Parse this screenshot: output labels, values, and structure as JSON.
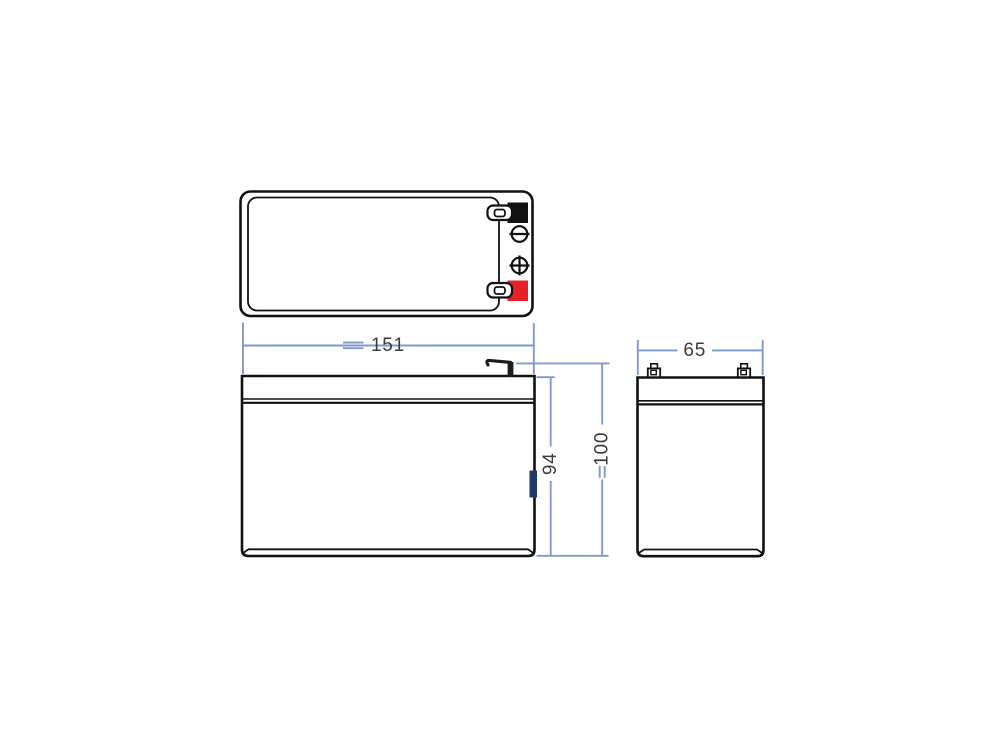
{
  "colors": {
    "outline": "#111111",
    "dimension_line": "#7E99CE",
    "label_text": "#3C3C3C",
    "terminal_negative": "#111111",
    "terminal_positive": "#E62128",
    "side_clip": "#1E3A66",
    "background": "#FFFFFF"
  },
  "icons": {
    "negative_symbol": "minus-in-circle",
    "positive_symbol": "plus-in-circle"
  },
  "dimensions": {
    "length": "151",
    "case_height": "94",
    "total_height": "100",
    "width": "65"
  }
}
